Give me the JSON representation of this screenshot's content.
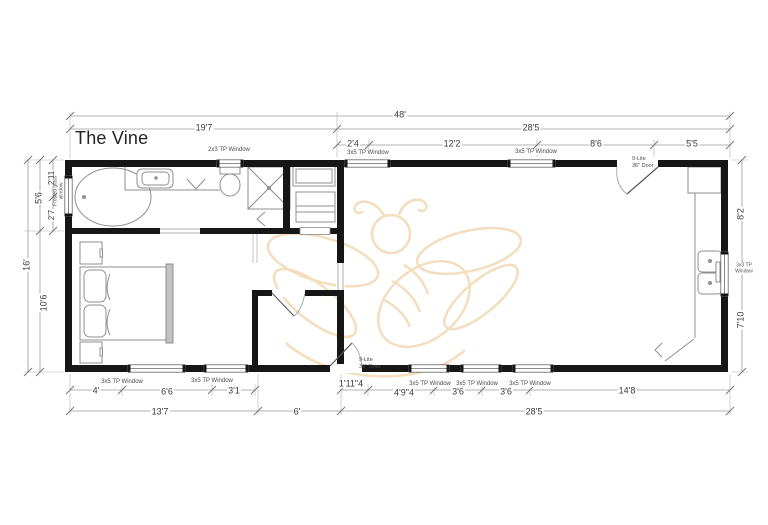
{
  "title": "The Vine",
  "watermark": {
    "name": "bee-logo",
    "color": "#f1dab6"
  },
  "dims": {
    "top": {
      "overall": "48'",
      "left": "19'7",
      "right": "28'5",
      "segments": [
        "2'4",
        "12'2",
        "8'6",
        "5'5"
      ]
    },
    "left": {
      "overall": "16'",
      "upper": "5'6",
      "lower": "10'6",
      "window_above": "2'11",
      "window_below": "2'7"
    },
    "right": {
      "upper": "8'2",
      "lower": "7'10"
    },
    "bottom": {
      "segments_left": [
        "4'",
        "6'6",
        "3'1"
      ],
      "segments_right": [
        "1'11\"4",
        "4'9\"4",
        "3'6",
        "3'6",
        "14'8"
      ],
      "totals": [
        "13'7",
        "6'",
        "28'5"
      ]
    }
  },
  "windows": {
    "top": [
      "2x3 TP Window",
      "3x5 TP Window",
      "3x5 TP Window"
    ],
    "bottom": [
      "3x5 TP Window",
      "3x5 TP Window",
      "3x5 TP Window",
      "3x5 TP Window",
      "3x5 TP Window"
    ],
    "left_tub": "Frosted glass window",
    "right_kitchen": "3x3 TP Window"
  },
  "doors": {
    "front": [
      "9-Lite",
      "36\" Door"
    ],
    "back": [
      "9-Lite",
      "36\" Door"
    ]
  }
}
